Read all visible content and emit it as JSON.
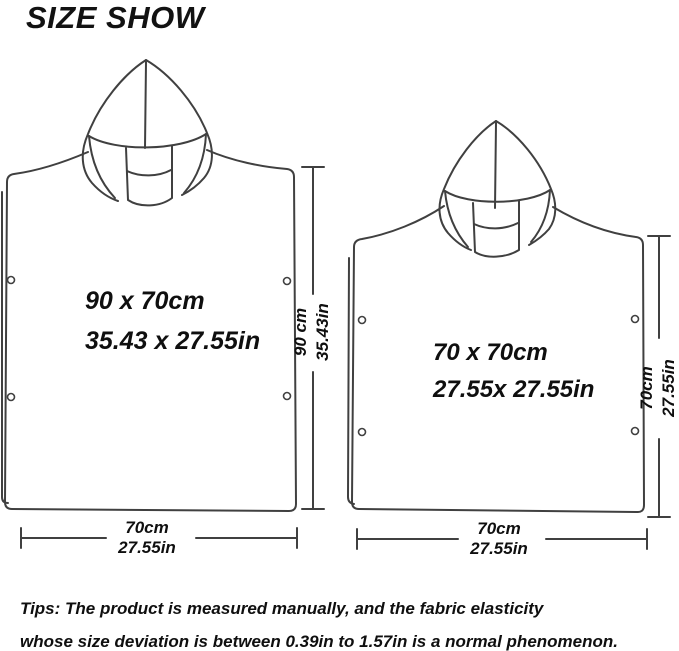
{
  "title": "SIZE SHOW",
  "colors": {
    "background": "#ffffff",
    "line": "#404040",
    "text": "#0f0f0f"
  },
  "ponchos": [
    {
      "name": "large-poncho",
      "size_cm": "90 x 70cm",
      "size_in": "35.43 x 27.55in",
      "height_cm": "90 cm",
      "height_in": "35.43in",
      "width_cm": "70cm",
      "width_in": "27.55in"
    },
    {
      "name": "small-poncho",
      "size_cm": "70 x 70cm",
      "size_in": "27.55x 27.55in",
      "height_cm": "70cm",
      "height_in": "27.55in",
      "width_cm": "70cm",
      "width_in": "27.55in"
    }
  ],
  "tips_line1": "Tips: The product is measured manually, and the fabric elasticity",
  "tips_line2": "whose size deviation is between 0.39in to 1.57in is a normal phenomenon."
}
